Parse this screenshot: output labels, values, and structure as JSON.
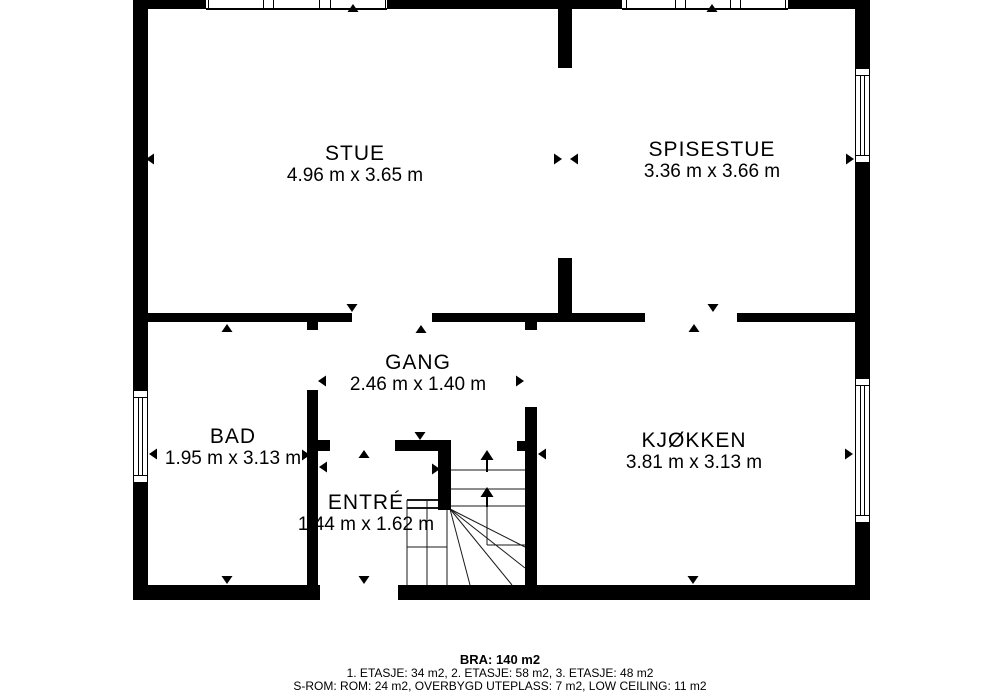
{
  "colors": {
    "background": "#ffffff",
    "wall": "#000000",
    "thin_line": "#1a1a1a"
  },
  "rooms": [
    {
      "name": "STUE",
      "dims": "4.96 m x 3.65 m",
      "cx": 355,
      "top": 142
    },
    {
      "name": "SPISESTUE",
      "dims": "3.36 m x 3.66 m",
      "cx": 712,
      "top": 138
    },
    {
      "name": "GANG",
      "dims": "2.46 m x 1.40 m",
      "cx": 418,
      "top": 351
    },
    {
      "name": "BAD",
      "dims": "1.95 m x 3.13 m",
      "cx": 233,
      "top": 425
    },
    {
      "name": "KJØKKEN",
      "dims": "3.81 m x 3.13 m",
      "cx": 694,
      "top": 429
    },
    {
      "name": "ENTRÉ",
      "dims": "1.44 m x 1.62 m",
      "cx": 366,
      "top": 491
    }
  ],
  "footer": {
    "bra": "BRA: 140 m2",
    "floors": "1. ETASJE: 34 m2, 2. ETASJE: 58 m2, 3. ETASJE: 48 m2",
    "srom": "S-ROM: ROM: 24 m2, OVERBYGD UTEPLASS: 7 m2, LOW CEILING: 11 m2"
  },
  "plan": {
    "walls": [
      [
        133,
        0,
        737,
        9
      ],
      [
        133,
        0,
        15,
        600
      ],
      [
        855,
        0,
        15,
        600
      ],
      [
        133,
        585,
        187,
        15
      ],
      [
        398,
        585,
        472,
        15
      ],
      [
        558,
        0,
        14,
        68
      ],
      [
        558,
        258,
        14,
        64
      ],
      [
        148,
        313,
        204,
        9
      ],
      [
        432,
        313,
        213,
        9
      ],
      [
        737,
        313,
        118,
        9
      ],
      [
        307,
        322,
        11,
        8
      ],
      [
        307,
        390,
        11,
        210
      ],
      [
        525,
        322,
        12,
        8
      ],
      [
        525,
        407,
        12,
        193
      ],
      [
        395,
        440,
        56,
        11
      ],
      [
        438,
        451,
        13,
        59
      ],
      [
        318,
        440,
        12,
        11
      ],
      [
        517,
        441,
        8,
        10
      ]
    ],
    "windows": [
      {
        "x": 206,
        "y": 0,
        "w": 181,
        "h": 10,
        "o": "h",
        "d": [
          2,
          57,
          67,
          113,
          124,
          179
        ]
      },
      {
        "x": 622,
        "y": 0,
        "w": 166,
        "h": 10,
        "o": "h",
        "d": [
          4,
          53,
          63,
          108,
          118,
          163
        ]
      },
      {
        "x": 855,
        "y": 68,
        "w": 15,
        "h": 95,
        "o": "v"
      },
      {
        "x": 855,
        "y": 378,
        "w": 15,
        "h": 145,
        "o": "v"
      },
      {
        "x": 133,
        "y": 390,
        "w": 15,
        "h": 93,
        "o": "v"
      }
    ],
    "dim_arrows": [
      {
        "x": 353,
        "y": 4,
        "d": "up"
      },
      {
        "x": 146,
        "y": 159,
        "d": "left"
      },
      {
        "x": 562,
        "y": 159,
        "d": "right"
      },
      {
        "x": 352,
        "y": 312,
        "d": "down"
      },
      {
        "x": 712,
        "y": 4,
        "d": "up"
      },
      {
        "x": 570,
        "y": 159,
        "d": "left"
      },
      {
        "x": 854,
        "y": 159,
        "d": "right"
      },
      {
        "x": 713,
        "y": 312,
        "d": "down"
      },
      {
        "x": 227,
        "y": 324,
        "d": "up"
      },
      {
        "x": 149,
        "y": 454,
        "d": "left"
      },
      {
        "x": 310,
        "y": 455,
        "d": "right"
      },
      {
        "x": 227,
        "y": 584,
        "d": "down"
      },
      {
        "x": 421,
        "y": 325,
        "d": "up"
      },
      {
        "x": 318,
        "y": 381,
        "d": "left"
      },
      {
        "x": 524,
        "y": 381,
        "d": "right"
      },
      {
        "x": 420,
        "y": 440,
        "d": "down"
      },
      {
        "x": 694,
        "y": 324,
        "d": "up"
      },
      {
        "x": 538,
        "y": 454,
        "d": "left"
      },
      {
        "x": 853,
        "y": 454,
        "d": "right"
      },
      {
        "x": 693,
        "y": 584,
        "d": "down"
      },
      {
        "x": 364,
        "y": 450,
        "d": "up"
      },
      {
        "x": 319,
        "y": 467,
        "d": "left"
      },
      {
        "x": 440,
        "y": 469,
        "d": "right"
      },
      {
        "x": 364,
        "y": 584,
        "d": "down"
      }
    ],
    "stair_lines": [
      [
        451,
        470,
        525,
        470,
        1
      ],
      [
        451,
        489,
        525,
        489,
        1
      ],
      [
        451,
        506,
        525,
        506,
        1
      ],
      [
        487,
        506,
        487,
        545,
        1
      ],
      [
        487,
        545,
        525,
        545,
        1
      ],
      [
        450,
        509,
        525,
        547,
        1
      ],
      [
        450,
        509,
        525,
        568,
        1
      ],
      [
        450,
        509,
        512,
        585,
        1
      ],
      [
        450,
        509,
        470,
        585,
        1
      ],
      [
        407,
        500,
        407,
        585,
        1
      ],
      [
        427,
        500,
        427,
        585,
        1
      ],
      [
        447,
        510,
        447,
        585,
        1
      ],
      [
        407,
        500,
        448,
        500,
        2
      ],
      [
        407,
        508,
        448,
        508,
        2
      ],
      [
        407,
        547,
        447,
        547,
        1
      ]
    ],
    "stair_arrows": [
      {
        "x": 487,
        "tip": 450,
        "base": 460,
        "shaft_end": 472
      },
      {
        "x": 487,
        "tip": 487,
        "base": 497,
        "shaft_end": 507
      }
    ]
  }
}
